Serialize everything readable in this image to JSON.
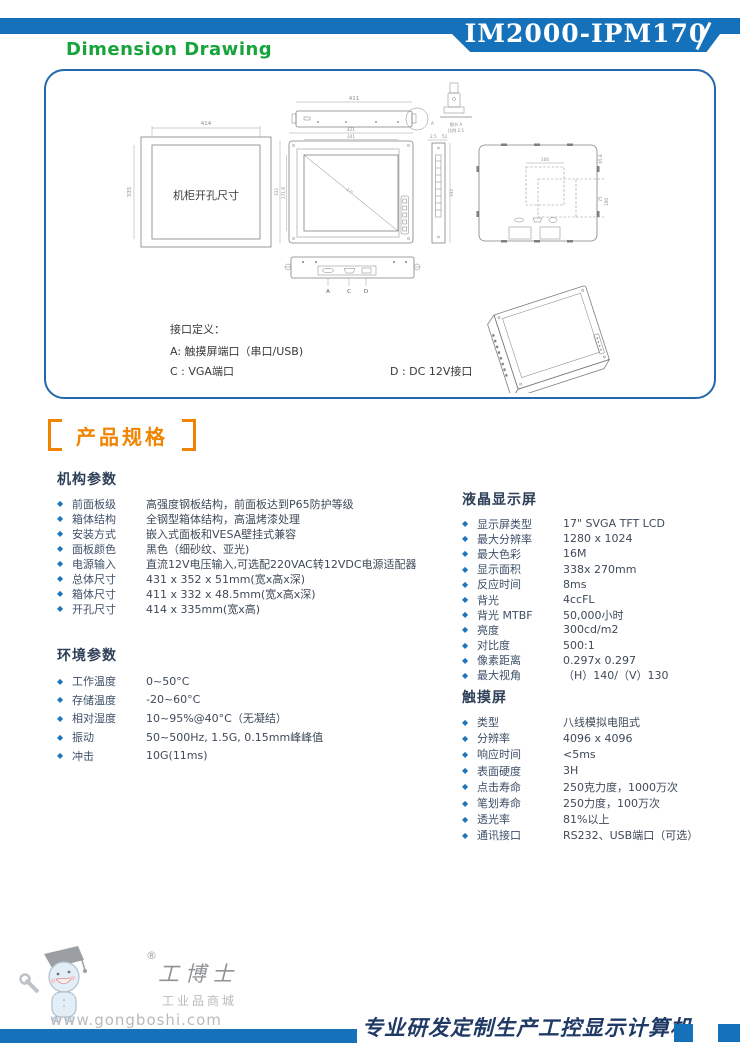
{
  "header": {
    "bar_title": "Dimension Drawing",
    "model": "IM2000-IPM170"
  },
  "drawing": {
    "cutout_label": "机柜开孔尺寸",
    "dims": {
      "cutout_w": "414",
      "cutout_h": "335",
      "top_w": "411",
      "front_w": "421",
      "screen_w": "341",
      "front_h": "332",
      "screen_h": "171.6",
      "side_t": "2.5",
      "side_d": "51",
      "side_h": "332",
      "vesa_w": "100",
      "vesa_h": "75",
      "vesa_h2": "100",
      "rear_edge": "65.8",
      "diagonal": "17\""
    },
    "detail": {
      "marker": "A",
      "label": "细节 A",
      "scale": "比例 2:1"
    },
    "ports": {
      "a": "A",
      "c": "C",
      "d": "D"
    },
    "interface": {
      "title": "接口定义：",
      "a": "A: 触摸屏端口（串口/USB)",
      "c": "C : VGA端口",
      "d": "D : DC 12V接口"
    }
  },
  "specs": {
    "heading": "产品规格",
    "groups": [
      {
        "title": "机构参数",
        "rows": [
          {
            "label": "前面板级",
            "value": "高强度钢板结构，前面板达到P65防护等级"
          },
          {
            "label": "箱体结构",
            "value": "全钢型箱体结构，高温烤漆处理"
          },
          {
            "label": "安装方式",
            "value": "嵌入式面板和VESA壁挂式兼容"
          },
          {
            "label": "面板颜色",
            "value": "黑色（细砂纹、亚光)"
          },
          {
            "label": "电源输入",
            "value": "直流12V电压输入,可选配220VAC转12VDC电源适配器"
          },
          {
            "label": "总体尺寸",
            "value": "431 x 352 x 51mm(宽x高x深)"
          },
          {
            "label": "箱体尺寸",
            "value": "411 x 332 x 48.5mm(宽x高x深)"
          },
          {
            "label": "开孔尺寸",
            "value": "414 x 335mm(宽x高)"
          }
        ]
      },
      {
        "title": "环境参数",
        "rows": [
          {
            "label": "工作温度",
            "value": "0~50°C"
          },
          {
            "label": "存储温度",
            "value": "-20~60°C"
          },
          {
            "label": "相对湿度",
            "value": "10~95%@40°C（无凝结）"
          },
          {
            "label": "振动",
            "value": "50~500Hz, 1.5G, 0.15mm峰峰值"
          },
          {
            "label": "冲击",
            "value": "10G(11ms)"
          }
        ]
      },
      {
        "title": "液晶显示屏",
        "rows": [
          {
            "label": "显示屏类型",
            "value": "17\" SVGA TFT LCD"
          },
          {
            "label": "最大分辨率",
            "value": "1280 x 1024"
          },
          {
            "label": "最大色彩",
            "value": "16M"
          },
          {
            "label": "显示面积",
            "value": "338x 270mm"
          },
          {
            "label": "反应时间",
            "value": "8ms"
          },
          {
            "label": "背光",
            "value": "4ccFL"
          },
          {
            "label": "背光 MTBF",
            "value": "50,000小时"
          },
          {
            "label": "亮度",
            "value": "300cd/m2"
          },
          {
            "label": "对比度",
            "value": "500:1"
          },
          {
            "label": "像素距离",
            "value": "0.297x 0.297"
          },
          {
            "label": "最大视角",
            "value": "（H）140/（V）130"
          }
        ]
      },
      {
        "title": "触摸屏",
        "rows": [
          {
            "label": "类型",
            "value": "八线模拟电阻式"
          },
          {
            "label": "分辨率",
            "value": "4096 x 4096"
          },
          {
            "label": "响应时间",
            "value": "<5ms"
          },
          {
            "label": "表面硬度",
            "value": "3H"
          },
          {
            "label": "点击寿命",
            "value": "250克力度，1000万次"
          },
          {
            "label": "笔划寿命",
            "value": "250力度，100万次"
          },
          {
            "label": "透光率",
            "value": "81%以上"
          },
          {
            "label": "通讯接口",
            "value": "RS232、USB端口（可选）"
          }
        ]
      }
    ]
  },
  "footer": {
    "logo_reg": "®",
    "logo_name": "工博士",
    "logo_tagline": "工业品商城",
    "logo_url": "www.gongboshi.com",
    "slogan": "专业研发定制生产工控显示计算机"
  },
  "colors": {
    "primary_blue": "#1471BA",
    "title_green": "#18A43C",
    "heading_orange": "#F08300",
    "slogan_navy": "#203A66",
    "spec_text": "#3E4D62"
  }
}
